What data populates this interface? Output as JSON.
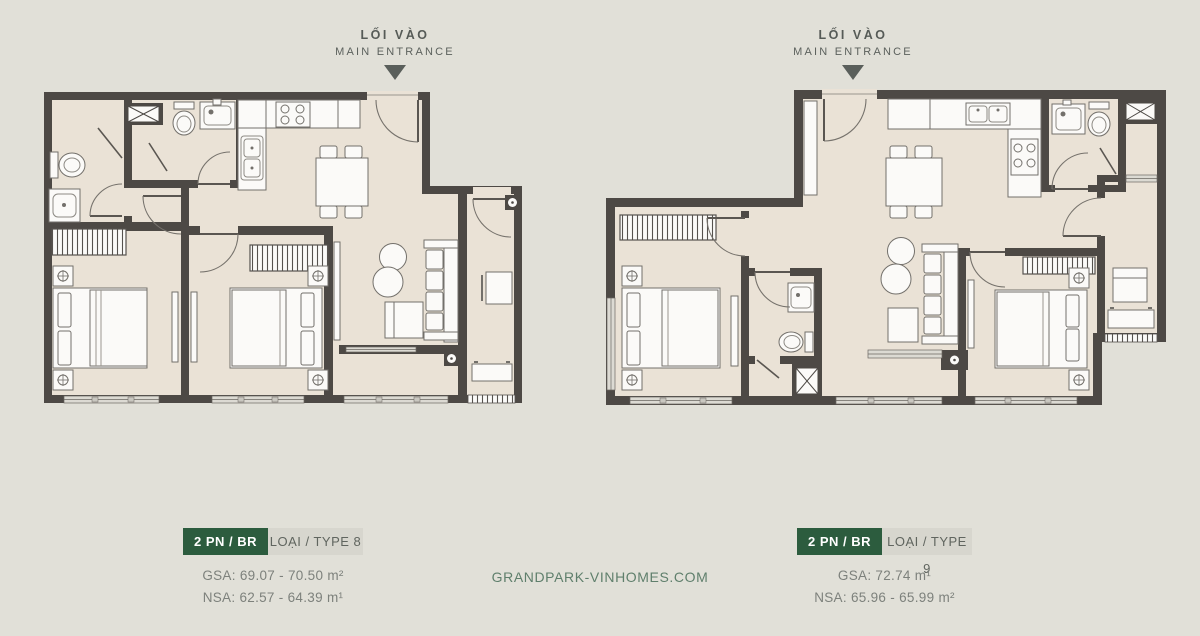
{
  "page": {
    "watermark": "GRANDPARK-VINHOMES.COM"
  },
  "colors": {
    "background": "#e1e0d8",
    "room_fill": "#eae2d6",
    "wall": "#4d4945",
    "accent_green": "#2c5c3e",
    "badge_gray_bg": "#d7d6ce",
    "stat_text": "#7d817c",
    "watermark_green": "#5f7f6c"
  },
  "plans": [
    {
      "entrance_vi": "LỐI VÀO",
      "entrance_en": "MAIN ENTRANCE",
      "rooms_badge": "2 PN / BR",
      "type_badge": "LOẠI / TYPE 8",
      "gsa": "GSA: 69.07 - 70.50 m²",
      "nsa": "NSA: 62.57 - 64.39 m¹"
    },
    {
      "entrance_vi": "LỐI VÀO",
      "entrance_en": "MAIN ENTRANCE",
      "rooms_badge": "2 PN / BR",
      "type_badge": "LOẠI / TYPE 9",
      "gsa": "GSA: 72.74 m¹",
      "nsa": "NSA: 65.96 - 65.99 m²"
    }
  ]
}
